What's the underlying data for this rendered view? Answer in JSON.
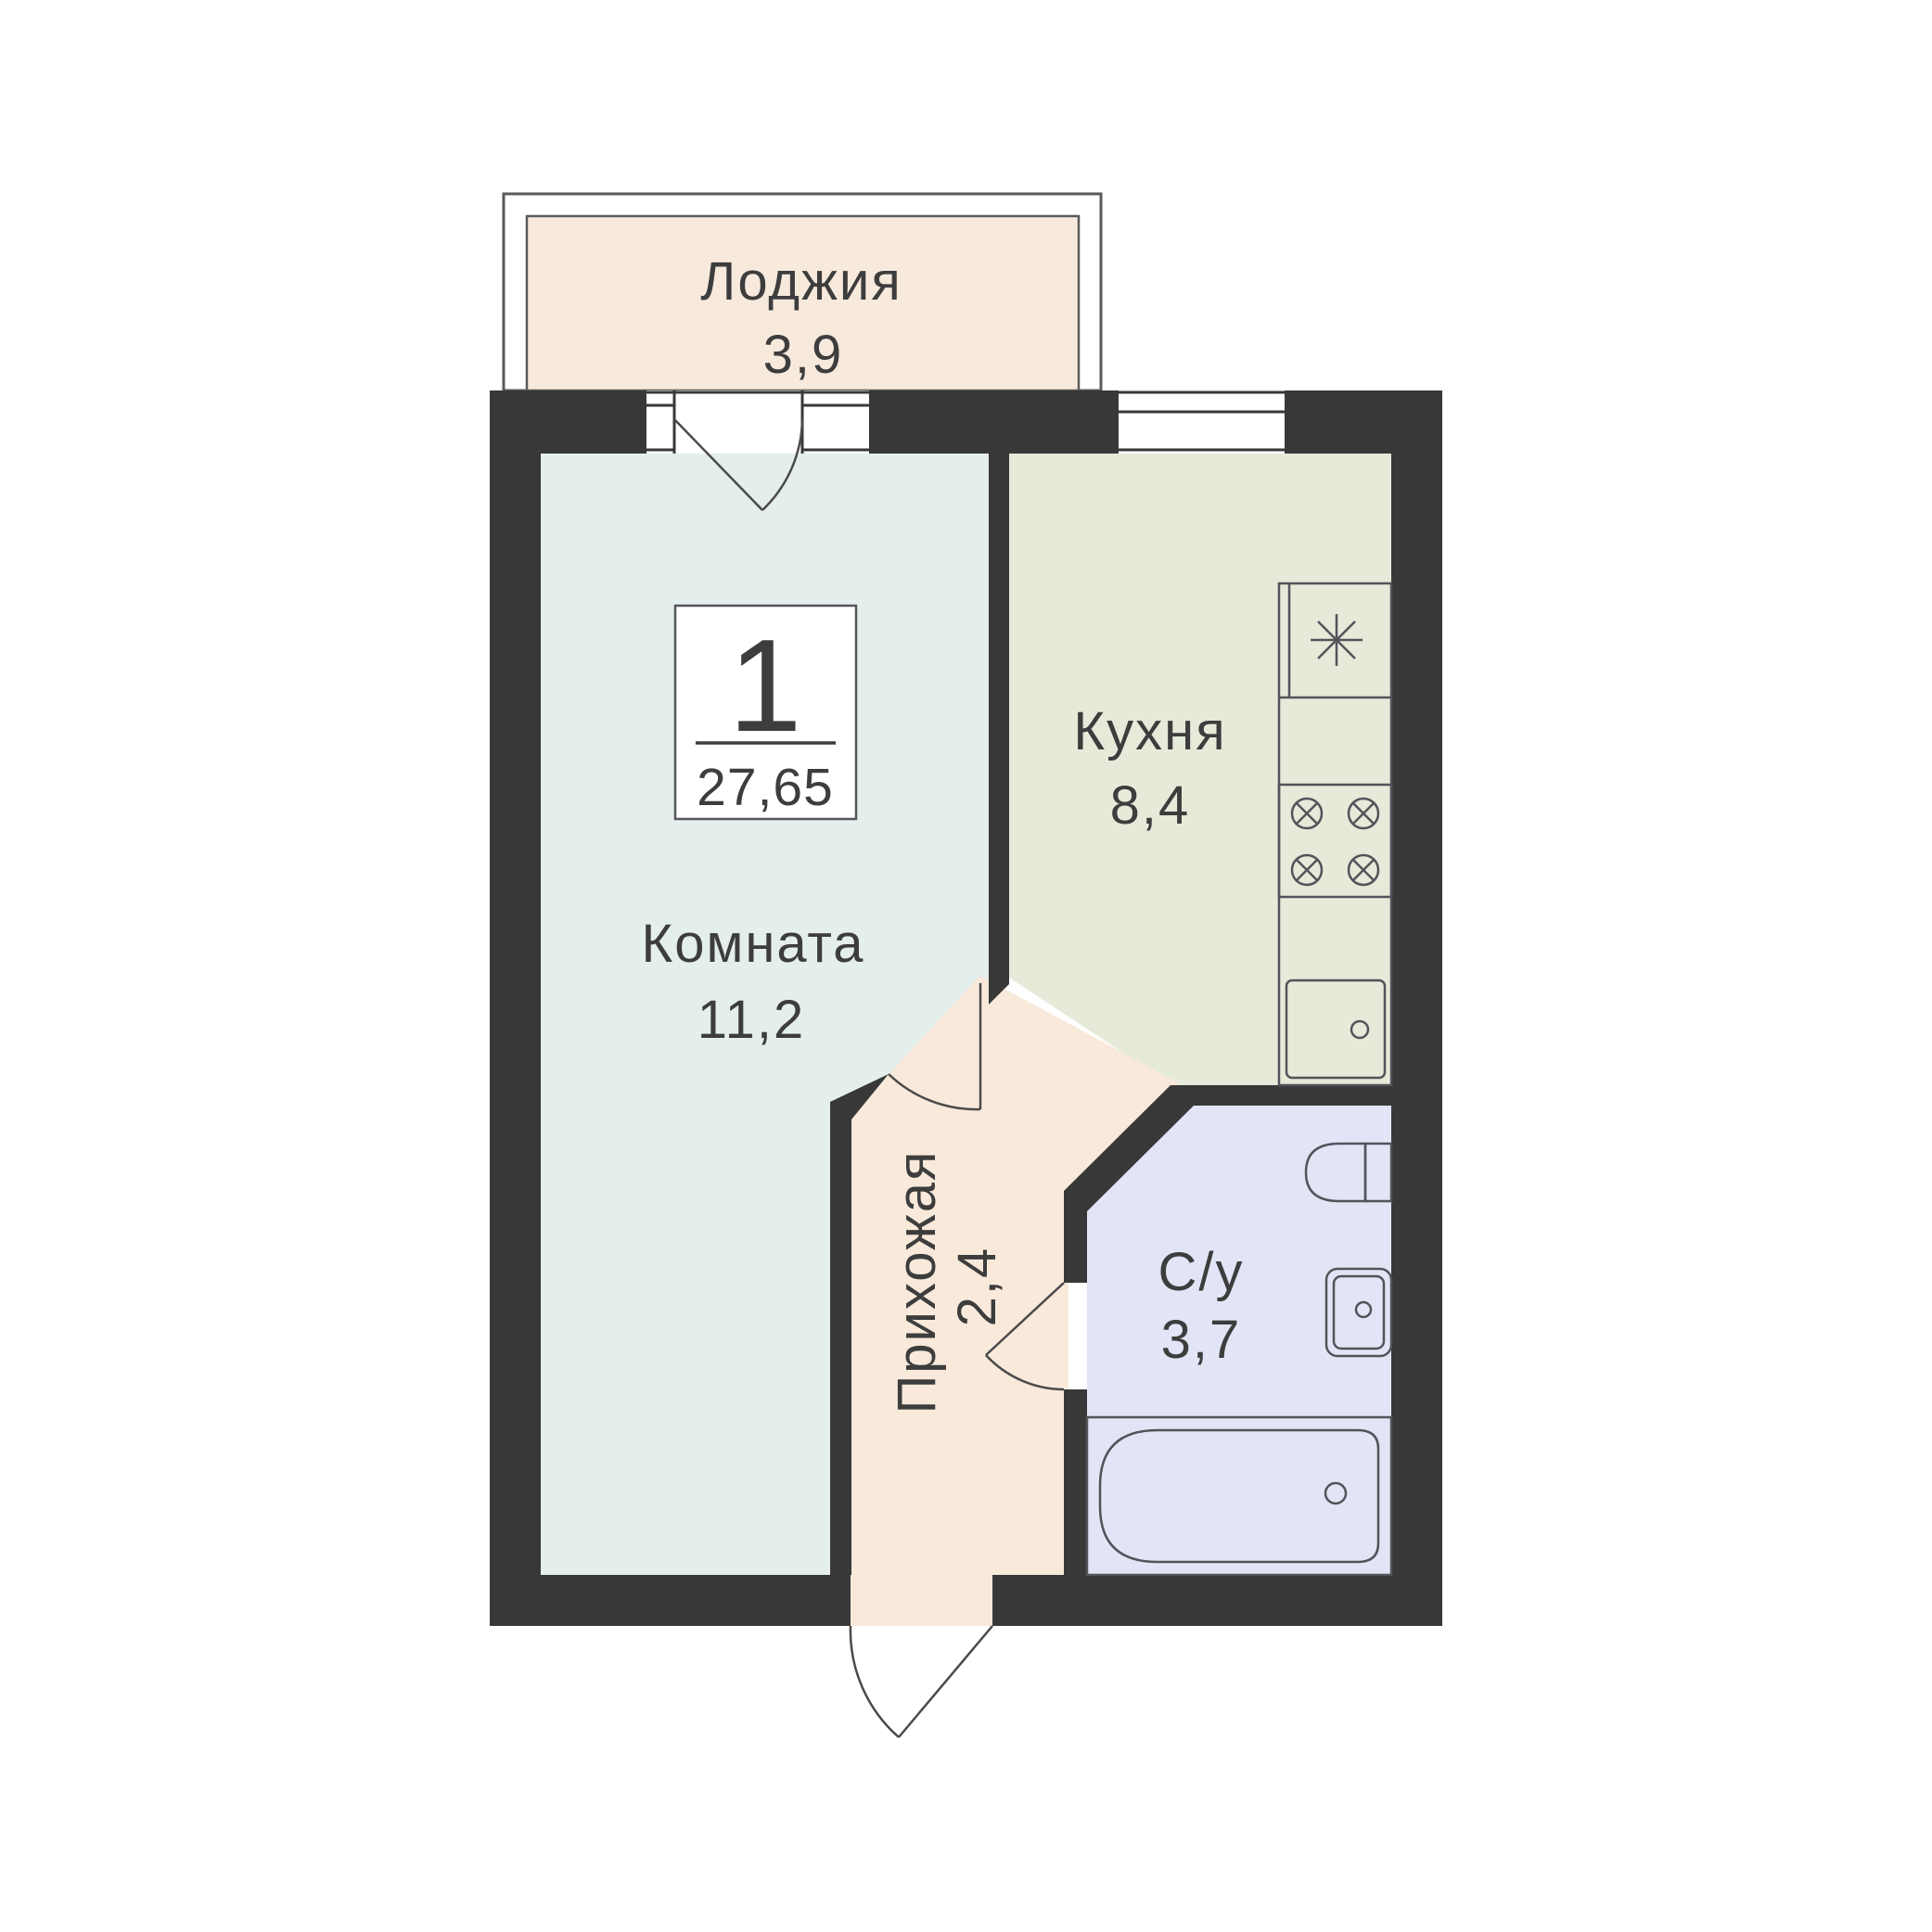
{
  "palette": {
    "background": "#ffffff",
    "wall": "#383838",
    "frame_line": "#5a5a5a",
    "door_line": "#4a4a4a",
    "fixture_line": "#53535a",
    "text": "#3d3d3d",
    "badge_border": "#55555a",
    "room_living": "#e4eeec",
    "room_kitchen": "#e5ead9",
    "room_bathroom": "#e1e5f6",
    "room_hall": "#f8e9db",
    "room_loggia": "#f7e9dc"
  },
  "unit": {
    "rooms_count": "1",
    "total_area": "27,65"
  },
  "rooms": {
    "loggia": {
      "name": "Лоджия",
      "area": "3,9"
    },
    "living": {
      "name": "Комната",
      "area": "11,2"
    },
    "kitchen": {
      "name": "Кухня",
      "area": "8,4"
    },
    "bathroom": {
      "name": "С/у",
      "area": "3,7"
    },
    "hall": {
      "name": "Прихожая",
      "area": "2,4"
    }
  }
}
